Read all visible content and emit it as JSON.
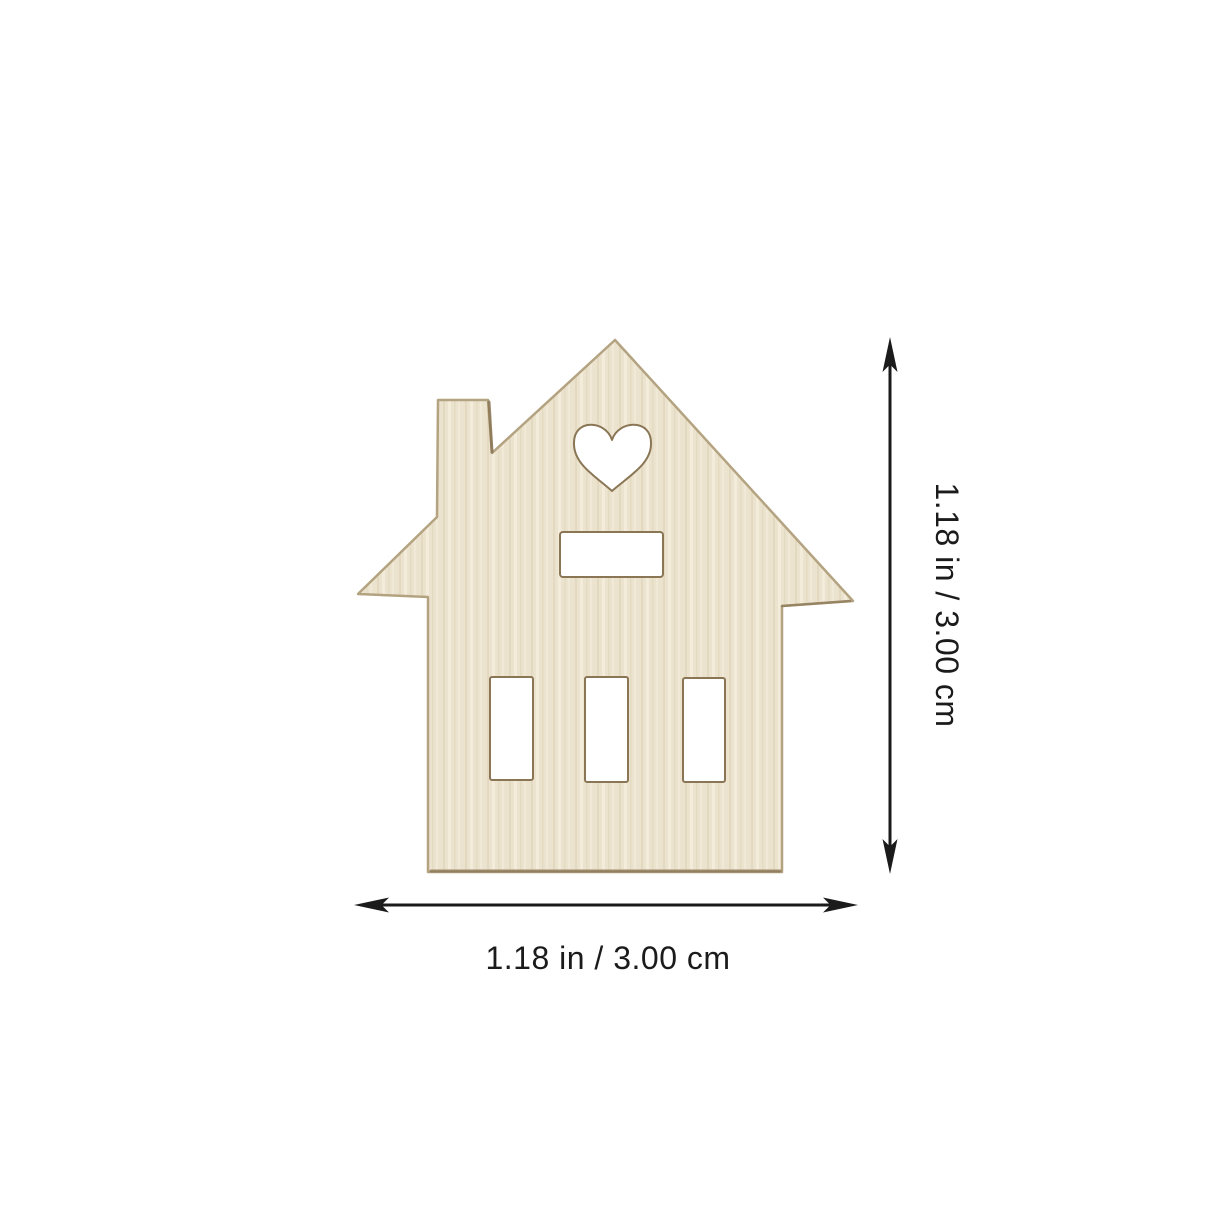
{
  "scene": {
    "background_color": "#ffffff",
    "subject": "wood-house-cutout",
    "colors": {
      "wood_base": "#ece3cf",
      "wood_grain_light": "#f5eedd",
      "wood_grain_dark": "#e0d5bb",
      "wood_edge": "#b3a381",
      "wood_edge_dark": "#8a7655",
      "cutout_fill": "#ffffff",
      "dimension": "#1b1b1b"
    },
    "dimensions": {
      "height_label": "1.18 in / 3.00 cm",
      "width_label": "1.18 in / 3.00 cm"
    }
  }
}
